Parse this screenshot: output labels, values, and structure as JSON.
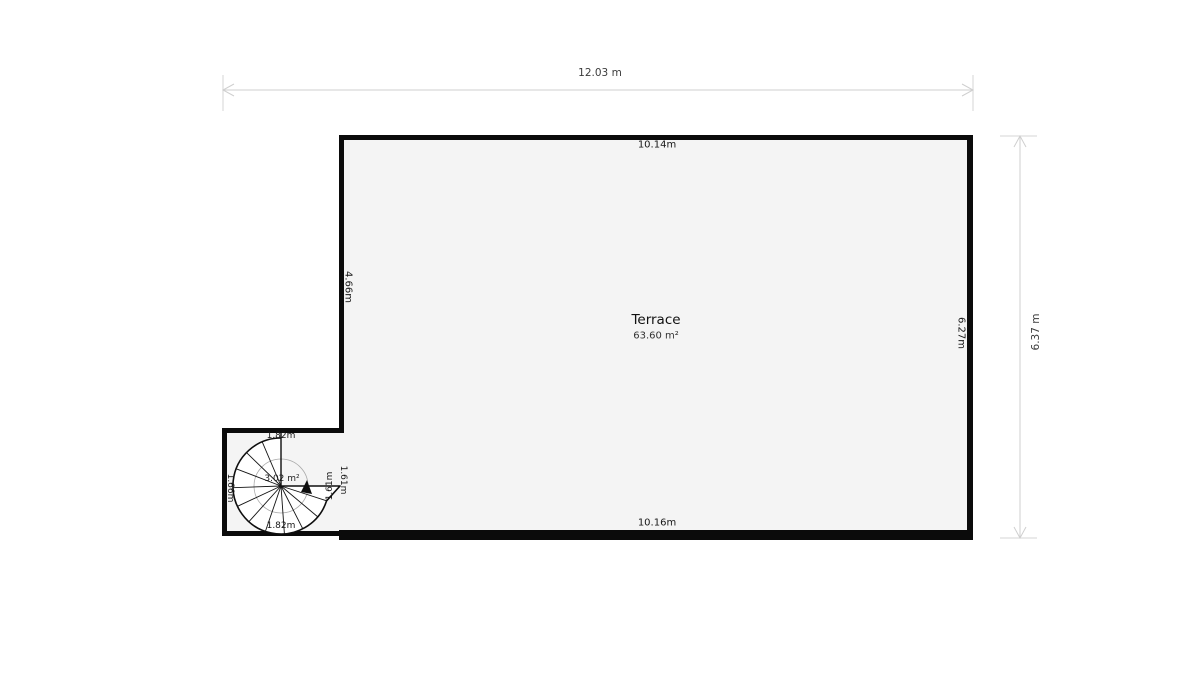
{
  "plan": {
    "room": {
      "title": "Terrace",
      "area": "63.60 m²"
    },
    "dimensions": {
      "overall_width": "12.03 m",
      "overall_height": "6.37 m",
      "top_interior": "10.14m",
      "bottom_interior": "10.16m",
      "left_interior": "4.66m",
      "right_interior": "6.27m"
    },
    "stair_room": {
      "area": "3.02 m²",
      "top": "1.82m",
      "bottom": "1.82m",
      "left": "1.66m",
      "opening_inner": "1.61m",
      "opening_outer": "1.61m"
    },
    "colors": {
      "wall": "#0b0b0b",
      "room_fill": "#f4f4f4",
      "dimension_line": "#cfcfcf"
    }
  }
}
